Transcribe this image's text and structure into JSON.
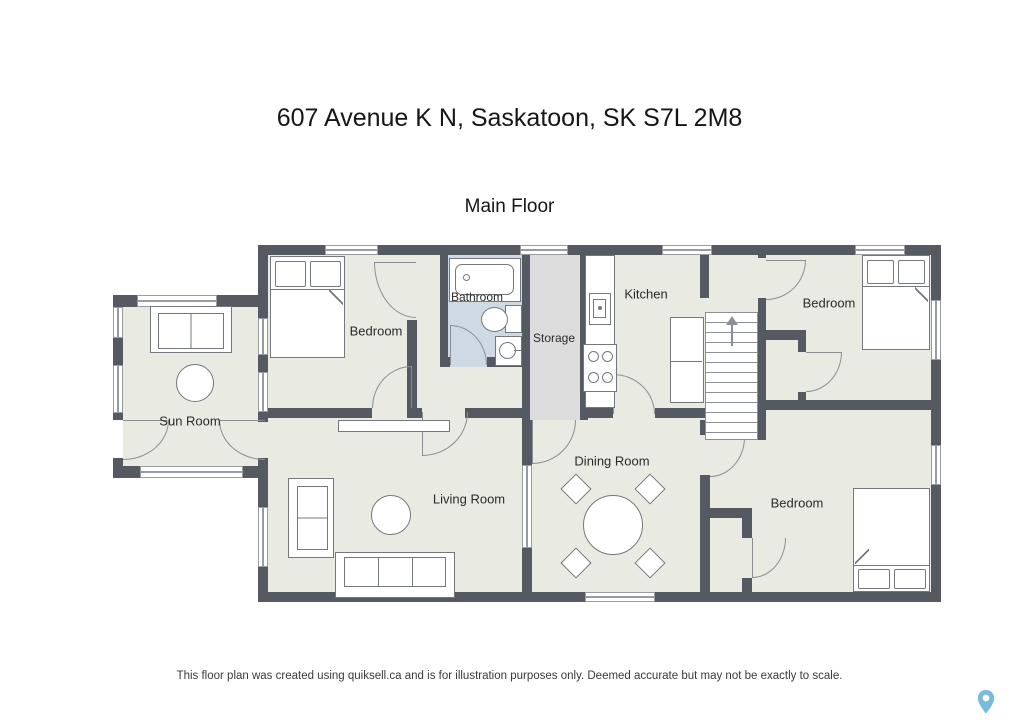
{
  "page": {
    "title": "607 Avenue K N, Saskatoon, SK S7L 2M8",
    "floor_label": "Main Floor",
    "disclaimer": "This floor plan was created using quiksell.ca and is for illustration purposes only. Deemed accurate but may not be exactly to scale."
  },
  "rooms": {
    "bedroom_top_left": "Bedroom",
    "bathroom": "Bathroom",
    "storage": "Storage",
    "kitchen": "Kitchen",
    "bedroom_top_right": "Bedroom",
    "sun_room": "Sun Room",
    "living_room": "Living Room",
    "dining_room": "Dining Room",
    "bedroom_bottom_right": "Bedroom"
  },
  "palette": {
    "wall": "#555a62",
    "floor": "#e9eae1",
    "bathroom_floor": "#cfd9e4",
    "storage_floor": "#dbdcdb",
    "line": "#8a8f96",
    "pin_accent": "#5fb0d6"
  },
  "icons": {
    "watermark": "map-pin"
  }
}
